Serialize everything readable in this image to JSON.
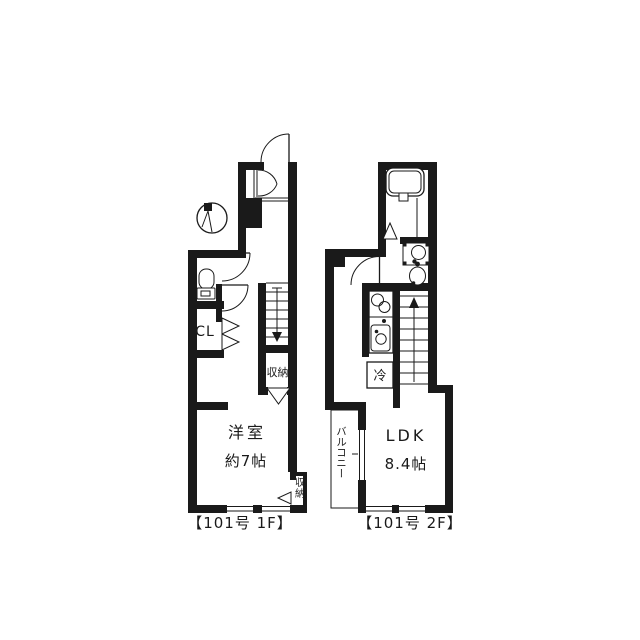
{
  "page": {
    "background": "#ffffff",
    "line_color": "#1a1a1a",
    "type_label": "apartment floor plan"
  },
  "floor_1f": {
    "caption": "【101号 1F】",
    "room_name": "洋室",
    "room_size": "約7帖",
    "closet": "CL",
    "storage_under_stairs": "収納",
    "storage_corner": "収納"
  },
  "floor_2f": {
    "caption": "【101号 2F】",
    "room_name": "LDK",
    "room_size": "8.4帖",
    "fridge": "冷",
    "balcony": "バルコニー"
  }
}
